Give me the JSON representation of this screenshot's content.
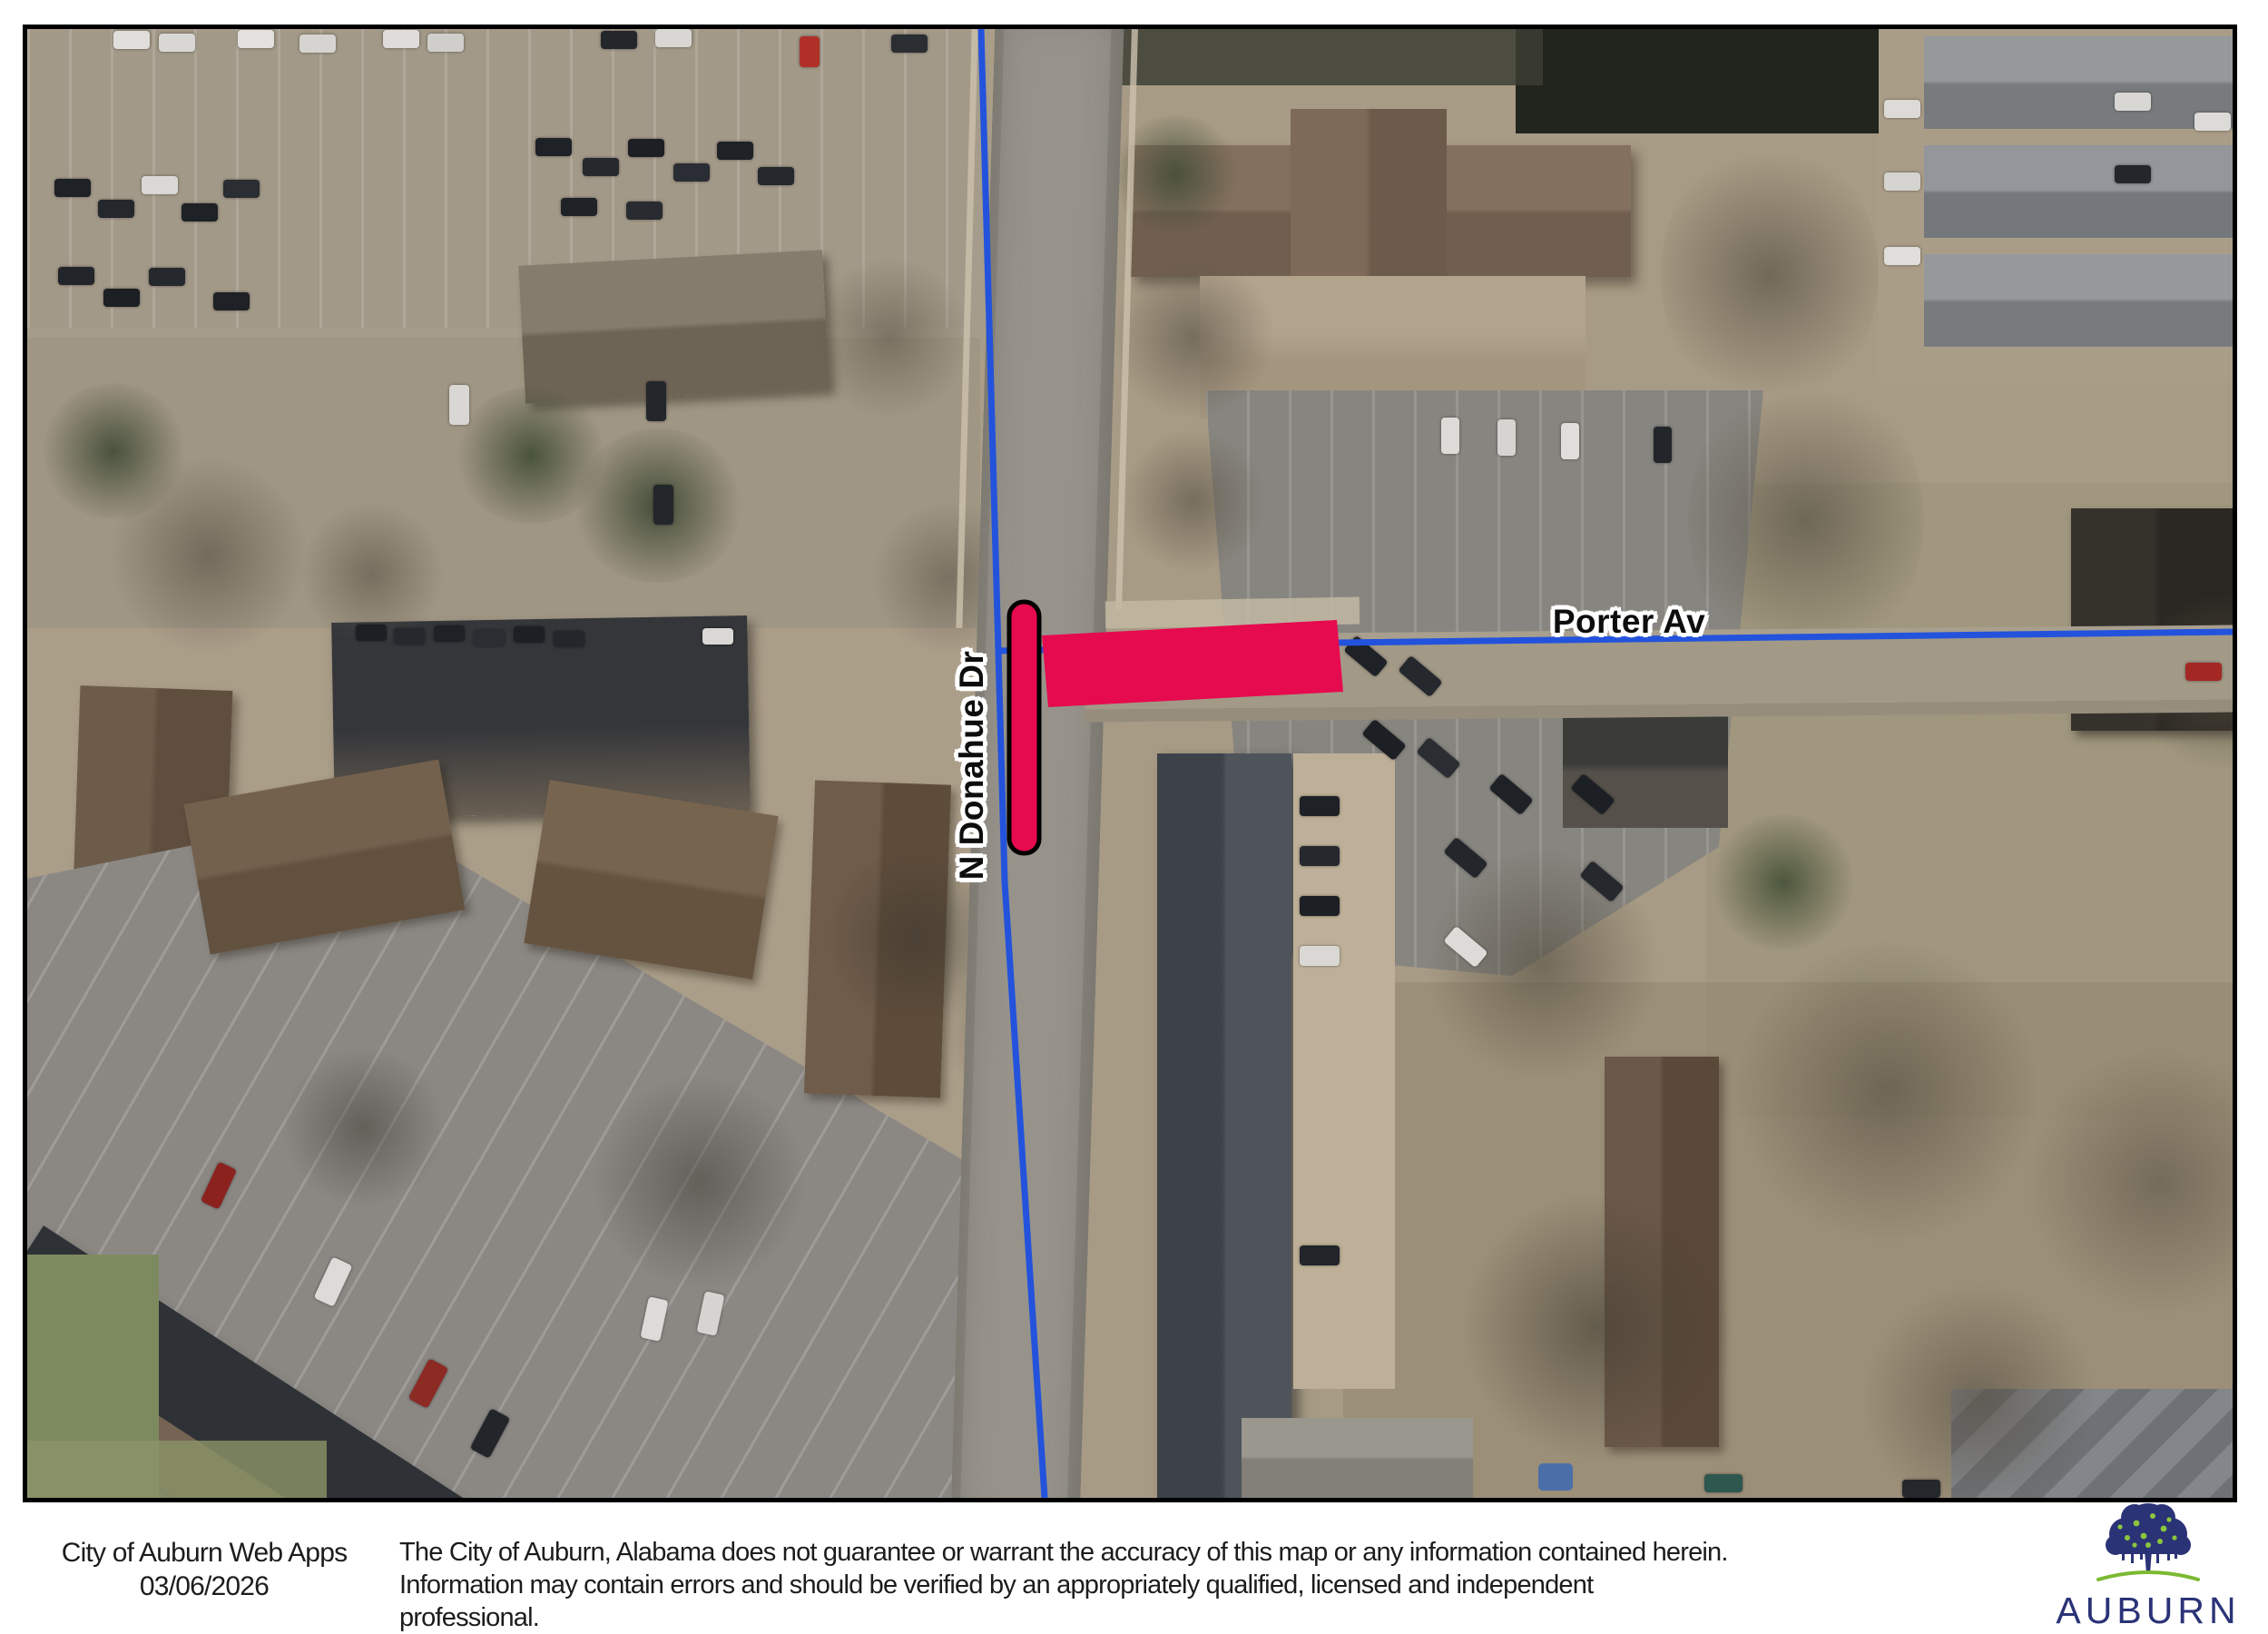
{
  "map": {
    "labels": {
      "n_donahue": "N Donahue Dr",
      "porter": "Porter Av"
    }
  },
  "colors": {
    "highlight_red": "#E60A4E",
    "route_blue": "#2353DC",
    "logo_navy": "#2B3377",
    "logo_green": "#8CC63E",
    "logo_ground_green": "#7CB932",
    "map_border": "#000000"
  },
  "footer": {
    "app_title": "City of Auburn Web Apps",
    "date": "03/06/2026",
    "disclaimer_line1": "The City of Auburn, Alabama does not guarantee or warrant the accuracy of this map or any information contained herein.",
    "disclaimer_line2": "Information may contain errors and should be verified by an appropriately qualified, licensed and independent professional.",
    "logo_text": "AUBURN"
  }
}
